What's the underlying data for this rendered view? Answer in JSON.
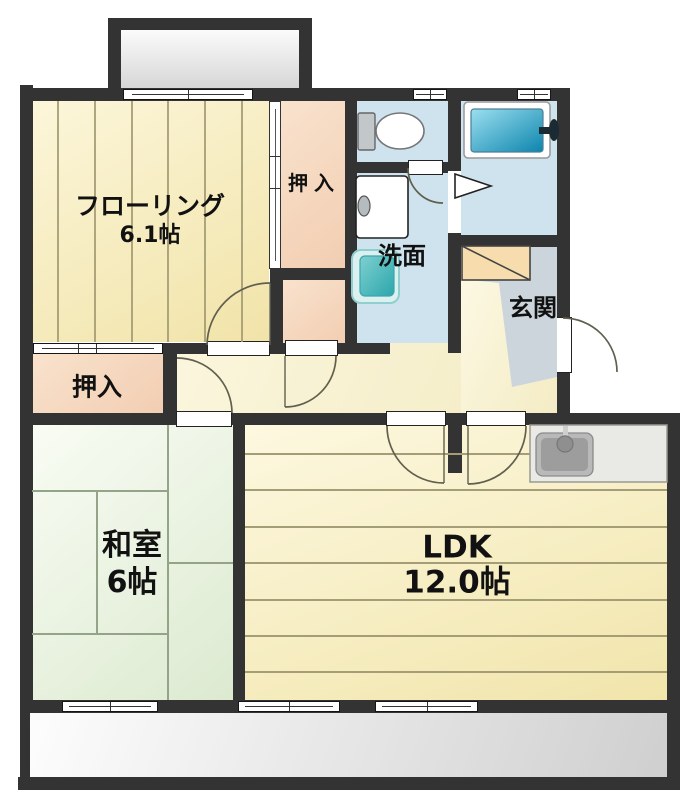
{
  "rooms": {
    "flooring": {
      "label": "フローリング",
      "size": "6.1帖"
    },
    "closet_top": {
      "label": "押入"
    },
    "closet_bottom": {
      "label": "押入"
    },
    "washroom": {
      "label": "洗面"
    },
    "entrance": {
      "label": "玄関"
    },
    "japanese_room": {
      "label": "和室",
      "size": "6帖"
    },
    "ldk": {
      "label": "LDK",
      "size": "12.0帖"
    }
  },
  "colors": {
    "wall": "#333333",
    "flooring_floor": "#f6ecba",
    "hall_floor": "#faf4d8",
    "tatami_floor": "#e6efda",
    "closet_floor": "#f6d9c0",
    "wet_room_floor": "#cfe3ee",
    "bathtub": "#0f8fb2",
    "washbasin": "#3fb0b4",
    "entrance_floor": "#cbd5db",
    "balcony_floor": "#e9e9e9",
    "shoe_cabinet": "#f7ddae",
    "kitchen_counter": "#e9e9e5",
    "plank_line": "#a59d75",
    "tatami_line": "#93a489",
    "text": "#111111"
  }
}
